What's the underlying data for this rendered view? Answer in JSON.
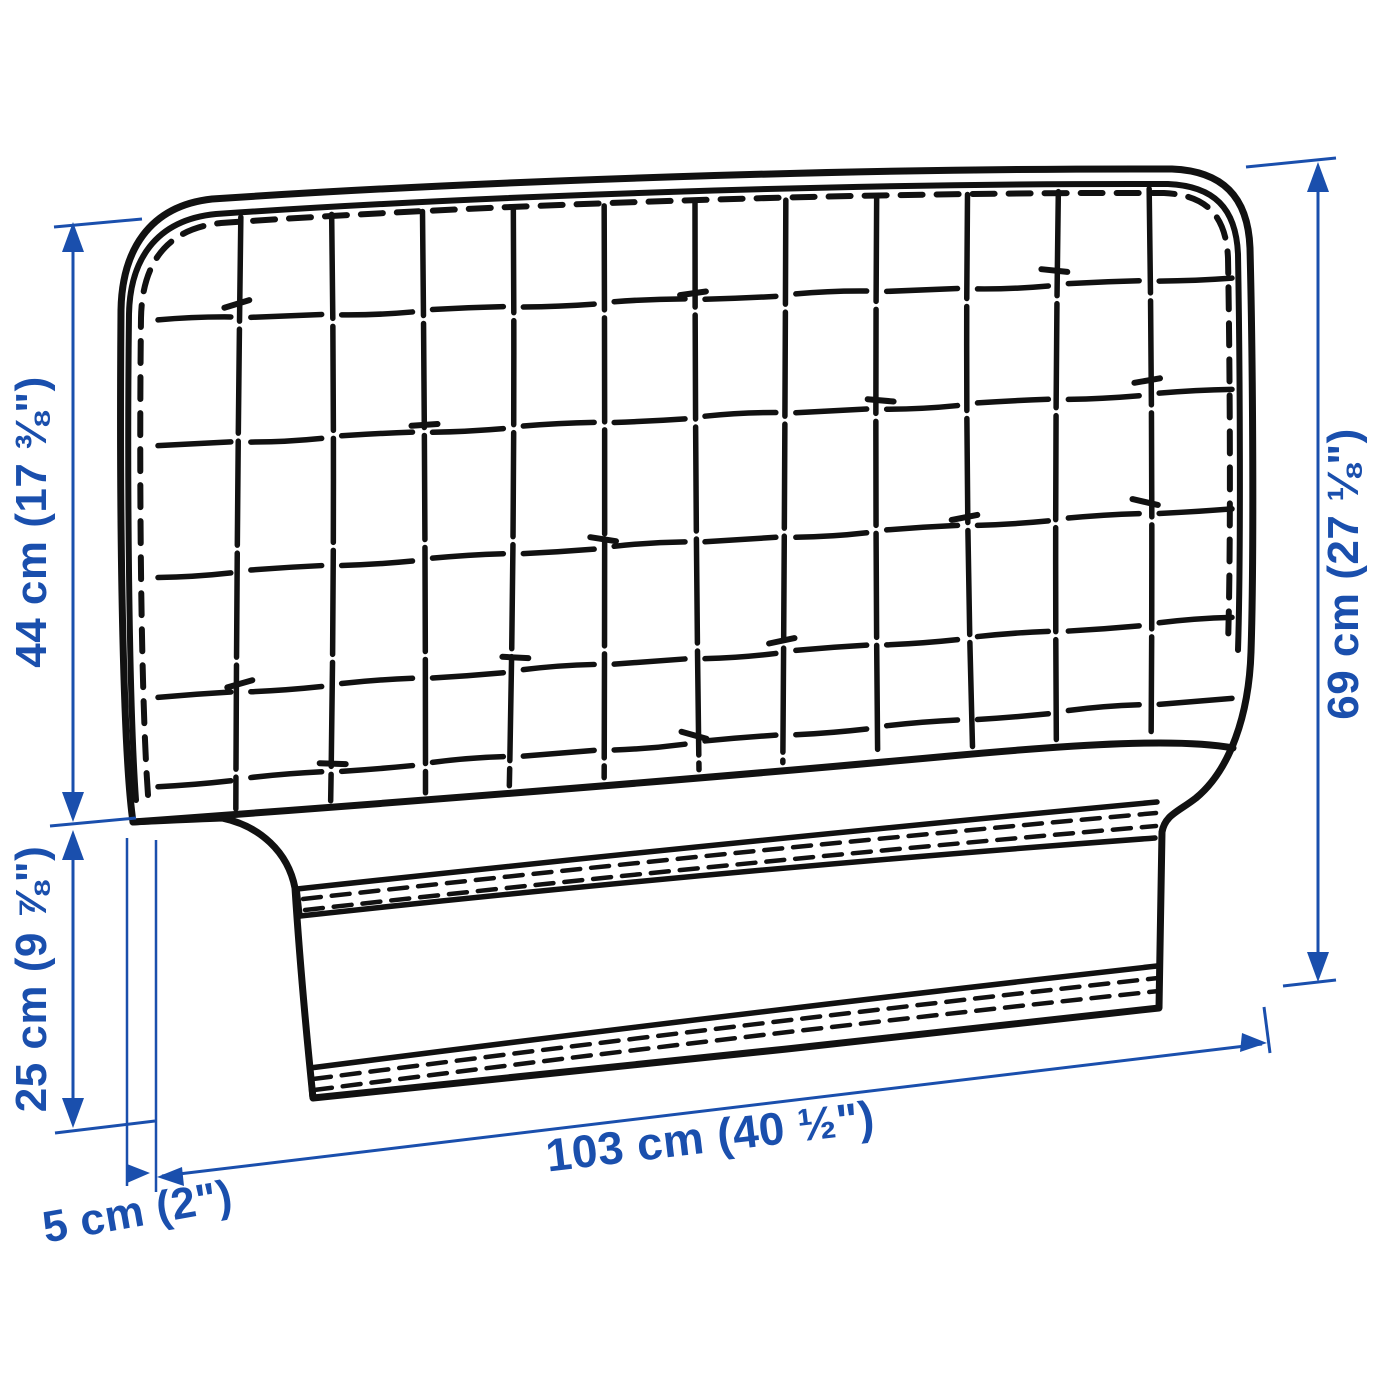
{
  "diagram": {
    "subject": "upholstered-headboard-line-drawing",
    "colors": {
      "dimension_blue": "#1a4fad",
      "outline_black": "#111111",
      "background": "#ffffff"
    }
  },
  "dimensions": {
    "upper_left_height": {
      "label": "44 cm (17 ⅜\")"
    },
    "lower_left_height": {
      "label": "25 cm (9 ⅞\")"
    },
    "right_height": {
      "label": "69 cm (27 ⅛\")"
    },
    "width": {
      "label": "103 cm (40 ½\")"
    },
    "depth": {
      "label": "5 cm (2\")"
    }
  }
}
